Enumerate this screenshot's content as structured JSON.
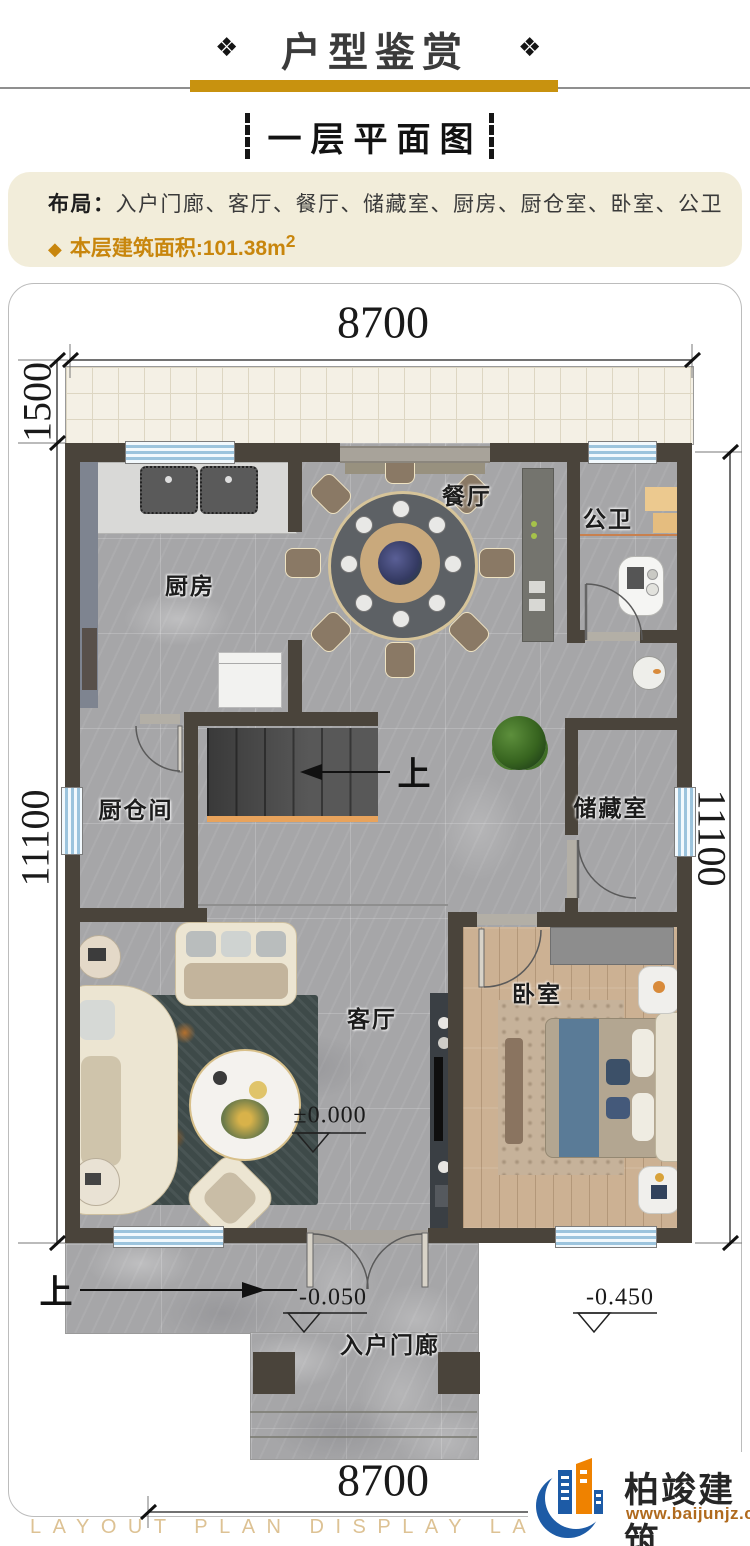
{
  "header": {
    "ornament_left": "❖",
    "ornament_right": "❖",
    "title": "户型鉴赏",
    "subtitle": "一层平面图"
  },
  "summary": {
    "layout_label": "布局：",
    "layout_items": "入户门廊、客厅、餐厅、储藏室、厨房、厨仓室、卧室、公卫",
    "area_bullet": "◆",
    "area_text": "本层建筑面积:101.38m",
    "area_superscript": "2"
  },
  "plan": {
    "dims": {
      "top": "8700",
      "bottom": "8700",
      "terrace_depth": "1500",
      "left_height": "11100",
      "right_height": "11100"
    },
    "rooms": {
      "dining": "餐厅",
      "bath": "公卫",
      "kitchen": "厨房",
      "pantry": "厨仓间",
      "storage": "储藏室",
      "living": "客厅",
      "bedroom": "卧室",
      "porch": "入户门廊"
    },
    "stairs_up": "上",
    "entry_up": "上",
    "levels": {
      "main": "±0.000",
      "porch": "-0.050",
      "ground": "-0.450"
    }
  },
  "footer": {
    "watermark": "LAYOUT PLAN DISPLAY LAYOUT PLAN DISPLAY",
    "brand_name": "柏竣建筑",
    "brand_url": "www.baijunjz.com"
  },
  "colors": {
    "gold_bar": "#c8920f",
    "gold_text": "#c8860d",
    "wall": "#4a443b",
    "window_blue": "#9cc4dd",
    "stair_accent": "#e8a35c"
  }
}
